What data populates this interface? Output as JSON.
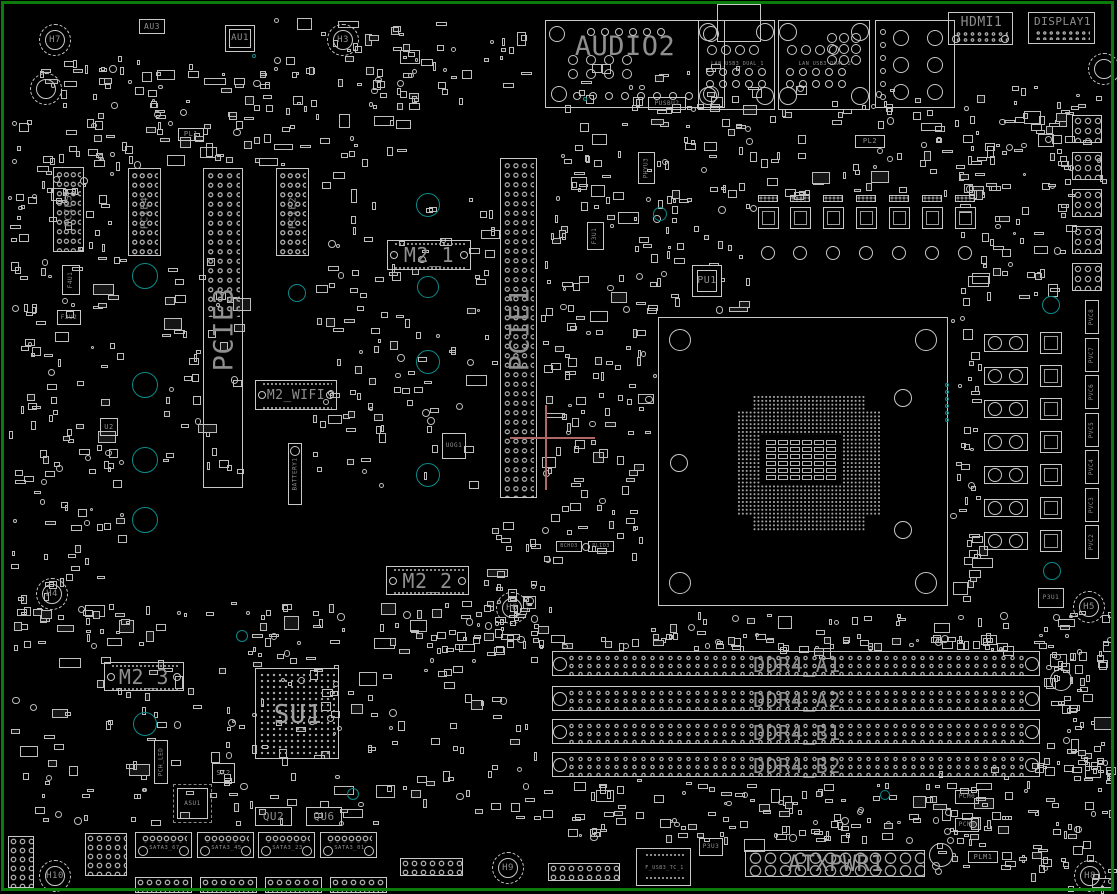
{
  "colors": {
    "bg": "#000000",
    "line": "#c8c8c8",
    "line2": "#a8a8a8",
    "label": "#8f8f8f",
    "board_outline": "#0b7b0b",
    "teal": "#0d8a8a",
    "crosshair": "#b06767"
  },
  "board": {
    "w": 1117,
    "h": 894
  },
  "top": {
    "audio": {
      "label": "AUDIO2",
      "x": 545,
      "y": 20,
      "w": 180,
      "h": 88
    },
    "lan": [
      {
        "label": "LAN_USB3_DUAL_1",
        "x": 698,
        "y": 20,
        "w": 77,
        "h": 90
      },
      {
        "label": "LAN_USB3_DUAL_2",
        "x": 778,
        "y": 20,
        "w": 92,
        "h": 90
      }
    ],
    "lan_module": {
      "x": 717,
      "y": 4,
      "w": 44,
      "h": 38
    },
    "usb_block": {
      "x": 875,
      "y": 20,
      "w": 80,
      "h": 88
    },
    "hdmi": {
      "label": "HDMI1",
      "x": 948,
      "y": 12,
      "w": 65,
      "h": 33
    },
    "display": {
      "label": "DISPLAY1",
      "x": 1028,
      "y": 12,
      "w": 67,
      "h": 32
    },
    "au3": {
      "label": "AU3",
      "x": 139,
      "y": 19,
      "w": 26,
      "h": 15
    },
    "au1": {
      "label": "AU1",
      "x": 225,
      "y": 25,
      "w": 30,
      "h": 27
    }
  },
  "slots": [
    {
      "id": "pcie5",
      "label": "PCIE5",
      "x": 53,
      "y": 167,
      "w": 31,
      "h": 85,
      "fs": 10,
      "dotsH": 85
    },
    {
      "id": "pcie4",
      "label": "PCIE4",
      "x": 128,
      "y": 168,
      "w": 33,
      "h": 88,
      "fs": 10,
      "dotsH": 88
    },
    {
      "id": "pcie3",
      "label": "PCIE3",
      "x": 203,
      "y": 168,
      "w": 40,
      "h": 320,
      "fs": 27,
      "dotsH": 150
    },
    {
      "id": "pcie2",
      "label": "PCIE2",
      "x": 276,
      "y": 168,
      "w": 33,
      "h": 88,
      "fs": 10,
      "dotsH": 88
    },
    {
      "id": "pcie1",
      "label": "PCIE1",
      "x": 500,
      "y": 158,
      "w": 37,
      "h": 340,
      "fs": 27,
      "dotsH": 340
    }
  ],
  "m2": [
    {
      "id": "m2_1",
      "label": "M2_1",
      "x": 387,
      "y": 240,
      "w": 84,
      "h": 30,
      "fs": 20
    },
    {
      "id": "m2_wifi",
      "label": "M2_WIFI",
      "x": 255,
      "y": 380,
      "w": 82,
      "h": 30,
      "fs": 13
    },
    {
      "id": "m2_2",
      "label": "M2_2",
      "x": 386,
      "y": 566,
      "w": 83,
      "h": 29,
      "fs": 20
    },
    {
      "id": "m2_3",
      "label": "M2_3",
      "x": 104,
      "y": 662,
      "w": 80,
      "h": 29,
      "fs": 20
    }
  ],
  "battery": {
    "label": "BATTERY1",
    "x": 288,
    "y": 443,
    "w": 14,
    "h": 62
  },
  "ddr": {
    "x": 552,
    "w": 488,
    "h": 25,
    "ys": [
      651,
      686,
      719,
      752
    ],
    "labels": [
      "DDR4_A1",
      "DDR4_A2",
      "DDR4_B1",
      "DDR4_B2"
    ]
  },
  "cpu": {
    "x": 658,
    "y": 317,
    "w": 290,
    "h": 289,
    "pin": {
      "x": 737,
      "y": 395,
      "w": 144,
      "h": 137
    },
    "center": {
      "x": 761,
      "y": 435,
      "w": 80,
      "h": 50
    },
    "caps": {
      "x": 766,
      "y": 440,
      "cols": 6,
      "rows": 6,
      "cw": 10,
      "ch": 5,
      "gx": 2,
      "gy": 2
    }
  },
  "su1": {
    "label": "SU1",
    "x": 255,
    "y": 668,
    "w": 84,
    "h": 91
  },
  "pu1": {
    "label": "PU1",
    "x": 692,
    "y": 265,
    "w": 30,
    "h": 32
  },
  "atx": {
    "label": "ATXPWR1",
    "x": 745,
    "y": 850,
    "w": 180,
    "h": 27
  },
  "sata": {
    "y": 832,
    "h": 26,
    "w": 57,
    "xs": [
      135,
      197,
      258,
      320
    ],
    "labels": [
      "SATA3_67",
      "SATA3_45",
      "SATA3_23",
      "SATA3_01"
    ]
  },
  "fusb": {
    "label": "F_USB3_TC_1",
    "x": 636,
    "y": 848,
    "w": 55,
    "h": 38
  },
  "chips": [
    {
      "label": "PUSBU2",
      "x": 648,
      "y": 97,
      "w": 38,
      "h": 13,
      "fs": 6
    },
    {
      "label": "P3U3",
      "x": 699,
      "y": 838,
      "w": 24,
      "h": 18,
      "fs": 6
    },
    {
      "label": "PLM1",
      "x": 968,
      "y": 851,
      "w": 30,
      "h": 12,
      "fs": 7
    },
    {
      "label": "PCM0",
      "x": 955,
      "y": 790,
      "w": 24,
      "h": 14,
      "fs": 6
    },
    {
      "label": "PCM0",
      "x": 955,
      "y": 818,
      "w": 24,
      "h": 14,
      "fs": 6
    },
    {
      "label": "P3U1",
      "x": 1038,
      "y": 588,
      "w": 26,
      "h": 20,
      "fs": 6
    },
    {
      "label": "F3U2",
      "x": 57,
      "y": 310,
      "w": 24,
      "h": 15,
      "fs": 6
    },
    {
      "label": "U2",
      "x": 100,
      "y": 418,
      "w": 18,
      "h": 18,
      "fs": 7
    },
    {
      "label": "UOG1",
      "x": 442,
      "y": 433,
      "w": 24,
      "h": 26,
      "fs": 6
    },
    {
      "label": "SX2",
      "x": 212,
      "y": 763,
      "w": 23,
      "h": 20,
      "fs": 7
    },
    {
      "label": "PL1",
      "x": 178,
      "y": 128,
      "w": 26,
      "h": 13,
      "fs": 7
    },
    {
      "label": "PL2",
      "x": 855,
      "y": 135,
      "w": 30,
      "h": 13,
      "fs": 7
    },
    {
      "label": "BCHO3",
      "x": 556,
      "y": 541,
      "w": 26,
      "h": 11,
      "fs": 5
    },
    {
      "label": "PLIO3",
      "x": 588,
      "y": 541,
      "w": 26,
      "h": 11,
      "fs": 5
    },
    {
      "label": "QU2",
      "x": 255,
      "y": 807,
      "w": 37,
      "h": 19,
      "fs": 11
    },
    {
      "label": "QU6",
      "x": 306,
      "y": 807,
      "w": 36,
      "h": 19,
      "fs": 11
    },
    {
      "label": "ASU1",
      "x": 177,
      "y": 788,
      "w": 31,
      "h": 31,
      "fs": 6
    }
  ],
  "vlabels": [
    {
      "label": "PHYU3",
      "x": 638,
      "y": 152,
      "w": 17,
      "h": 32
    },
    {
      "label": "F3U1",
      "x": 587,
      "y": 222,
      "w": 17,
      "h": 28
    },
    {
      "label": "F4U1",
      "x": 62,
      "y": 265,
      "w": 18,
      "h": 30
    },
    {
      "label": "PCH_LED",
      "x": 154,
      "y": 740,
      "w": 14,
      "h": 44
    }
  ],
  "pvc": {
    "x": 1085,
    "w": 14,
    "h": 34,
    "y0": 300,
    "step": 37.5,
    "labels": [
      "PVC8",
      "PVC7",
      "PVC6",
      "PVC5",
      "PVC4",
      "PVC3",
      "PVC2"
    ]
  },
  "holes": [
    {
      "label": "H7",
      "cx": 55,
      "cy": 40
    },
    {
      "label": "H3",
      "cx": 343,
      "cy": 40
    },
    {
      "label": "",
      "cx": 1104,
      "cy": 69
    },
    {
      "label": "",
      "cx": 46,
      "cy": 89
    },
    {
      "label": "H4",
      "cx": 52,
      "cy": 594
    },
    {
      "label": "H6",
      "cx": 512,
      "cy": 608
    },
    {
      "label": "H5",
      "cx": 1089,
      "cy": 607
    },
    {
      "label": "H10",
      "cx": 55,
      "cy": 876
    },
    {
      "label": "H9",
      "cx": 508,
      "cy": 868
    },
    {
      "label": "H8",
      "cx": 1090,
      "cy": 876
    }
  ],
  "teal": [
    {
      "cx": 145,
      "cy": 276,
      "r": 13
    },
    {
      "cx": 145,
      "cy": 385,
      "r": 13
    },
    {
      "cx": 145,
      "cy": 460,
      "r": 13
    },
    {
      "cx": 145,
      "cy": 520,
      "r": 13
    },
    {
      "cx": 297,
      "cy": 293,
      "r": 9
    },
    {
      "cx": 428,
      "cy": 205,
      "r": 12
    },
    {
      "cx": 428,
      "cy": 287,
      "r": 11
    },
    {
      "cx": 428,
      "cy": 362,
      "r": 12
    },
    {
      "cx": 428,
      "cy": 475,
      "r": 12
    },
    {
      "cx": 660,
      "cy": 214,
      "r": 7
    },
    {
      "cx": 145,
      "cy": 724,
      "r": 12
    },
    {
      "cx": 242,
      "cy": 636,
      "r": 6
    },
    {
      "cx": 353,
      "cy": 794,
      "r": 6
    },
    {
      "cx": 885,
      "cy": 795,
      "r": 5
    },
    {
      "cx": 1051,
      "cy": 305,
      "r": 9
    },
    {
      "cx": 1052,
      "cy": 571,
      "r": 9
    },
    {
      "cx": 254,
      "cy": 56,
      "r": 2
    },
    {
      "cx": 585,
      "cy": 99,
      "r": 2
    }
  ],
  "teal_dots": {
    "x": 947,
    "y0": 385,
    "step": 7,
    "n": 6,
    "r": 2
  },
  "crosshair": {
    "hx": 510,
    "hy": 437,
    "hlen": 85,
    "vx": 545,
    "vy": 405,
    "vlen": 85
  },
  "vrm_top": {
    "xs": [
      758,
      790,
      823,
      856,
      889,
      922,
      955
    ],
    "padY": 195,
    "sqY": 207,
    "capY": 246
  },
  "vrm_right": {
    "capX": 984,
    "sqX": 1040,
    "y0": 334,
    "step": 33,
    "n": 7
  },
  "edge_headers": {
    "x": 1072,
    "w": 30,
    "h": 28,
    "ys": [
      115,
      152,
      189,
      226,
      263
    ]
  },
  "pin_headers": [
    {
      "x": 400,
      "y": 858,
      "w": 63,
      "h": 18
    },
    {
      "x": 548,
      "y": 863,
      "w": 72,
      "h": 18
    },
    {
      "x": 135,
      "y": 877,
      "w": 57,
      "h": 16
    },
    {
      "x": 200,
      "y": 877,
      "w": 57,
      "h": 16
    },
    {
      "x": 265,
      "y": 877,
      "w": 57,
      "h": 16
    },
    {
      "x": 330,
      "y": 877,
      "w": 57,
      "h": 16
    },
    {
      "x": 85,
      "y": 833,
      "w": 42,
      "h": 43
    },
    {
      "x": 8,
      "y": 836,
      "w": 26,
      "h": 52
    }
  ],
  "misc_circles": [
    {
      "cx": 1061,
      "cy": 680,
      "r": 11
    },
    {
      "cx": 941,
      "cy": 855,
      "r": 12
    }
  ],
  "noise": [
    [
      40,
      55,
      370,
      108,
      130,
      11
    ],
    [
      260,
      15,
      270,
      85,
      55,
      12
    ],
    [
      8,
      118,
      112,
      515,
      170,
      13
    ],
    [
      162,
      258,
      75,
      215,
      40,
      14
    ],
    [
      312,
      150,
      70,
      330,
      42,
      15
    ],
    [
      348,
      195,
      145,
      295,
      65,
      16
    ],
    [
      545,
      58,
      210,
      250,
      140,
      17
    ],
    [
      760,
      85,
      345,
      112,
      110,
      18
    ],
    [
      958,
      128,
      110,
      172,
      60,
      19
    ],
    [
      540,
      300,
      115,
      258,
      90,
      20
    ],
    [
      950,
      312,
      32,
      295,
      38,
      21
    ],
    [
      650,
      612,
      395,
      36,
      55,
      22
    ],
    [
      8,
      600,
      540,
      222,
      235,
      23
    ],
    [
      380,
      598,
      172,
      52,
      42,
      24
    ],
    [
      560,
      778,
      420,
      62,
      125,
      25
    ],
    [
      930,
      762,
      180,
      125,
      78,
      26
    ],
    [
      1042,
      610,
      68,
      172,
      42,
      27
    ],
    [
      478,
      500,
      70,
      138,
      32,
      28
    ],
    [
      560,
      636,
      480,
      12,
      40,
      29
    ],
    [
      1045,
      640,
      62,
      138,
      36,
      30
    ]
  ]
}
